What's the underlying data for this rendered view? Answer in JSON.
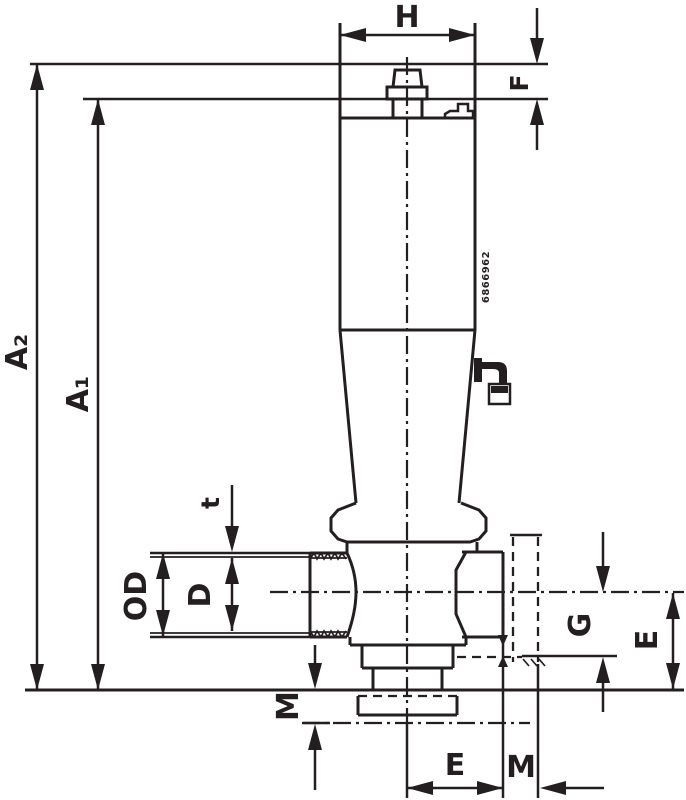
{
  "drawing": {
    "type": "technical-dimension-drawing",
    "subject": "valve elevation with dimension lines",
    "colors": {
      "ink": "#231f20",
      "background": "#ffffff"
    },
    "labels": {
      "top_width": "H",
      "knob_height": "F",
      "overall_height": "A₂",
      "shoulder_height": "A₁",
      "thread_depth": "t",
      "port_outer_diameter": "OD",
      "port_bore_diameter": "D",
      "base_offset_left": "M",
      "outlet_depth_right": "G",
      "side_height_right": "E",
      "bottom_center_to_face": "E",
      "bottom_offset": "M",
      "body_marking": "6866962"
    }
  }
}
